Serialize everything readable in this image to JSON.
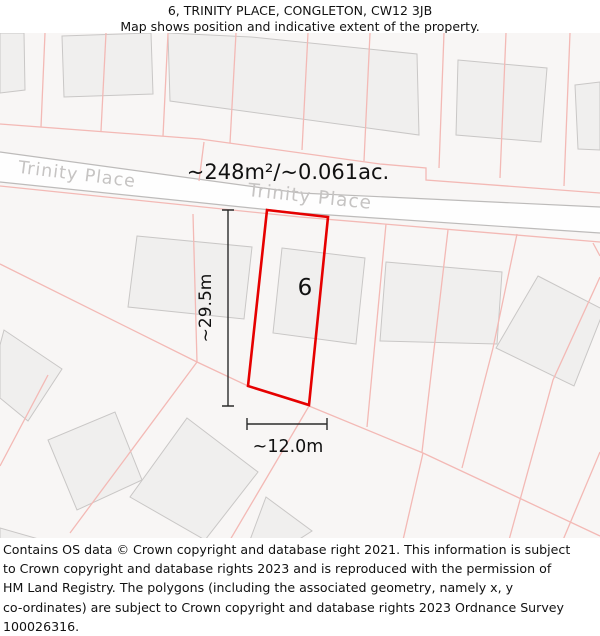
{
  "header": {
    "title": "6, TRINITY PLACE, CONGLETON, CW12 3JB",
    "subtitle": "Map shows position and indicative extent of the property."
  },
  "map": {
    "street_label_1": "Trinity Place",
    "street_label_2": "Trinity Place",
    "area_label": "~248m²/~0.061ac.",
    "plot_number": "6",
    "dim_vertical_label": "~29.5m",
    "dim_horizontal_label": "~12.0m",
    "colors": {
      "plot_outline": "#e60000",
      "parcel_line": "#f3b9b5",
      "building_fill": "#f0efee",
      "building_stroke": "#c9c7c6",
      "road_edge": "#bdbbba",
      "street_text": "#c6c4c3",
      "map_bg": "#f8f6f5"
    }
  },
  "footer": {
    "lines": [
      "Contains OS data © Crown copyright and database right 2021. This information is subject",
      "to Crown copyright and database rights 2023 and is reproduced with the permission of",
      "HM Land Registry. The polygons (including the associated geometry, namely x, y",
      "co-ordinates) are subject to Crown copyright and database rights 2023 Ordnance Survey",
      "100026316."
    ]
  }
}
